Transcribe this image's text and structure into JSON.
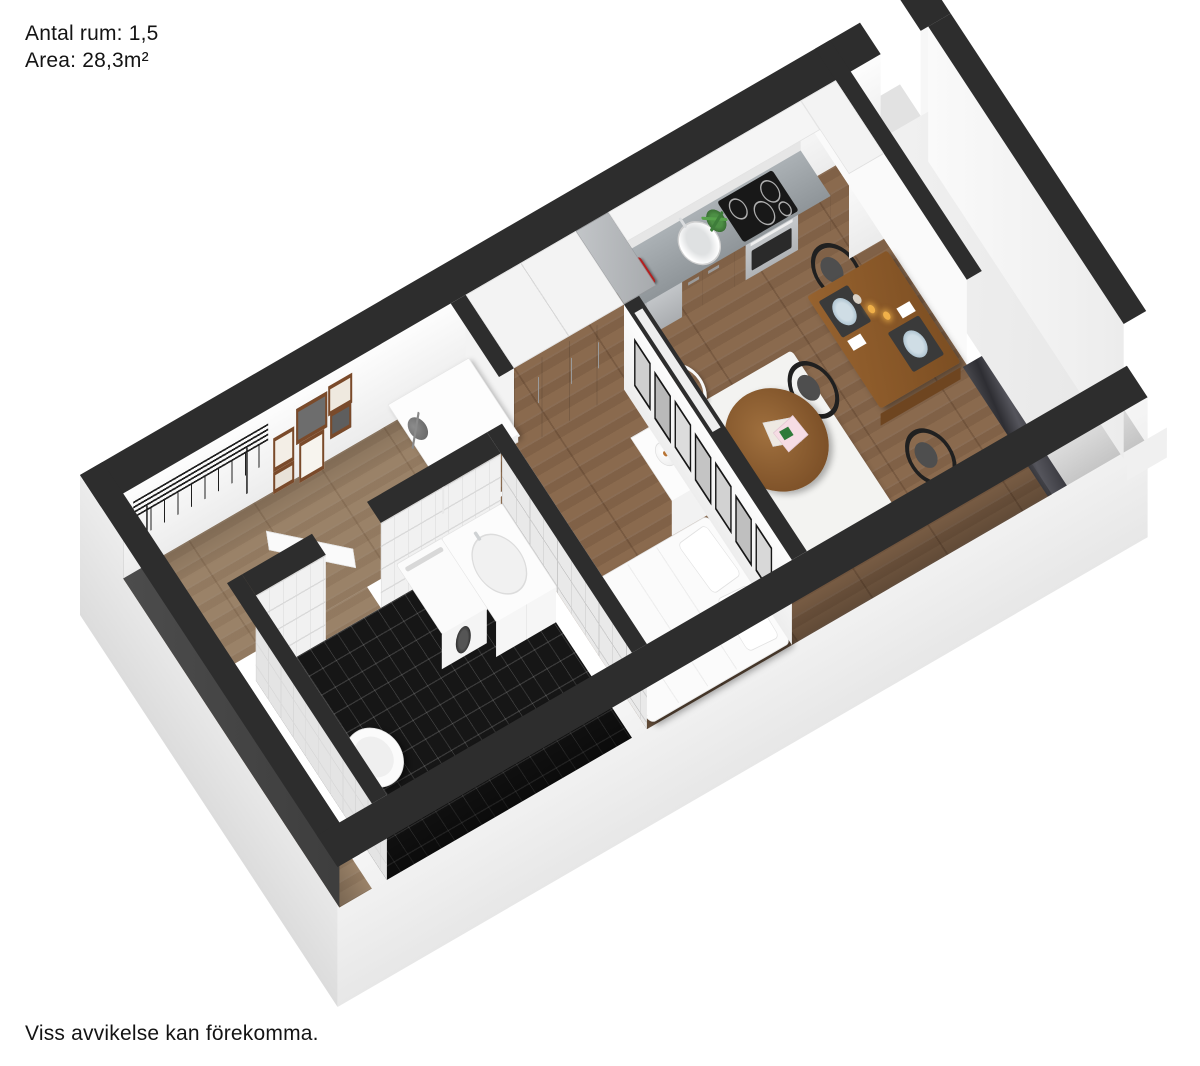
{
  "header": {
    "rooms_line": "Antal rum: 1,5",
    "area_line": "Area: 28,3m²"
  },
  "footer": {
    "disclaimer": "Viss avvikelse kan förekomma."
  },
  "palette": {
    "wall_cap": "#2d2d2d",
    "wall_inner_shadow": "#474747",
    "wood_main": "#8a6a4e",
    "wood_hall": "#9a8268",
    "tile_black": "#161616",
    "tile_white": "#f1f1f1",
    "counter_top": "#9aa0a4",
    "fridge_steel": "#b4b7ba",
    "dining_table_wood": "#8a5a2b",
    "accent_coffee_maker": "#b51f1f",
    "plate_blue": "#a9bfcd",
    "candle_flame": "#f0b049",
    "outer_skirt": "#efefef"
  }
}
